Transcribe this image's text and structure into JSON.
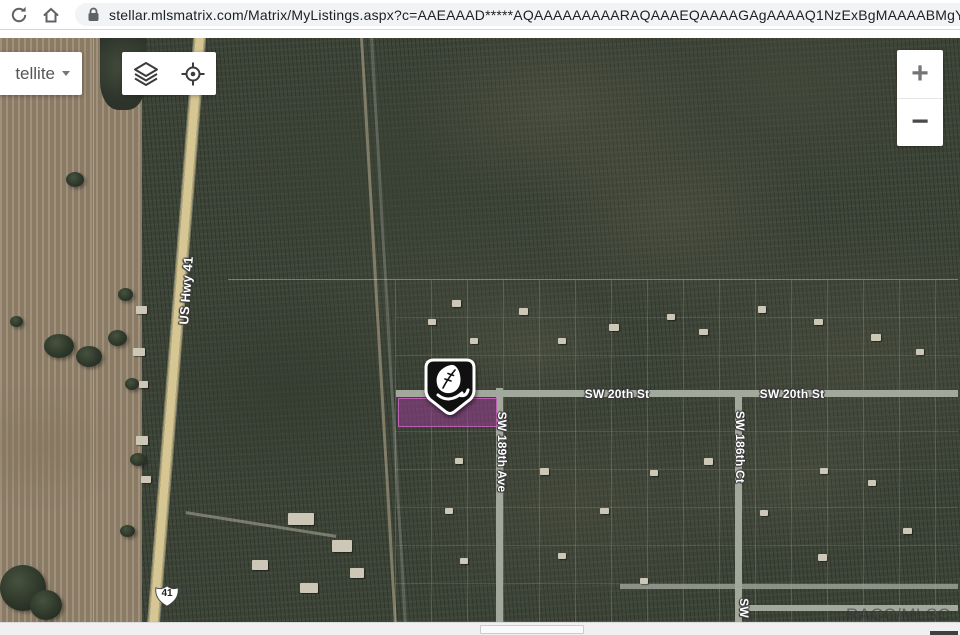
{
  "browser": {
    "url": "stellar.mlsmatrix.com/Matrix/MyListings.aspx?c=AAEAAAD*****AQAAAAAAAAARAQAAAEQAAAAGAgAAAAQ1NzExBgMAAAABMgYEAAAA"
  },
  "map_controls": {
    "map_type_label": "tellite",
    "zoom_in_label": "+",
    "zoom_out_label": "−"
  },
  "map": {
    "route_shield_label": "41",
    "streets": {
      "us_hwy": "US Hwy 41",
      "sw20_west": "SW 20th St",
      "sw20_east": "SW 20th St",
      "sw189": "SW 189th Ave",
      "sw186": "SW 186th Ct",
      "sw_bottom": "SW"
    },
    "watermark": "RACC/MLS",
    "watermark_partial": "C",
    "colors": {
      "parcel_fill": "rgba(152,60,146,0.55)",
      "parcel_border": "rgba(196,98,186,0.9)",
      "field_tan": "#95846D",
      "forest_green": "#3C4337",
      "road_gray": "#A3A89C",
      "highway_tan": "#D5C693"
    },
    "icons": {
      "marker": "tree-pin-marker",
      "layers": "layers-icon",
      "locate": "crosshair-icon"
    }
  }
}
